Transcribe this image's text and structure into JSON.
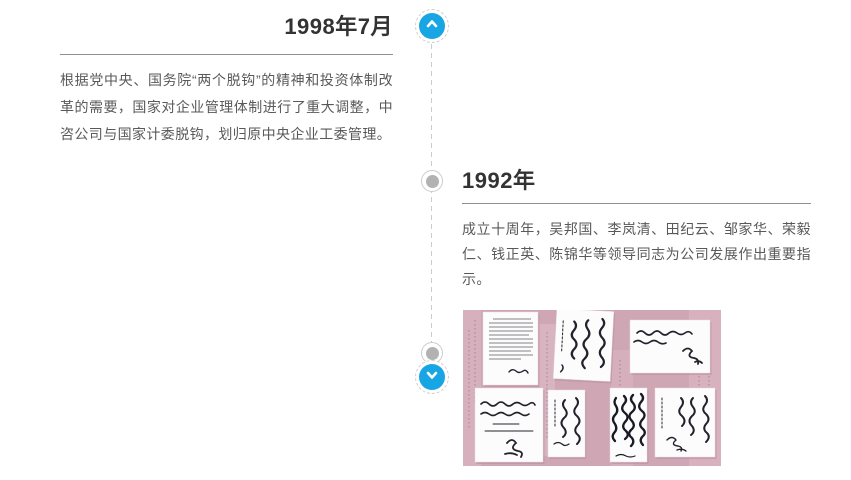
{
  "timeline": {
    "accent_color": "#17a5e3",
    "line_color": "#cccccc",
    "node_color": "#b2b2b2",
    "up_button": {
      "icon": "chevron-up"
    },
    "down_button": {
      "icon": "chevron-down"
    }
  },
  "events": [
    {
      "side": "left",
      "title": "1998年7月",
      "body": "根据党中央、国务院“两个脱钩”的精神和投资体制改革的需要，国家对企业管理体制进行了重大调整，中咨公司与国家计委脱钩，划归原中央企业工委管理。"
    },
    {
      "side": "right",
      "title": "1992年",
      "body": "成立十周年，吴邦国、李岚清、田纪云、邹家华、荣毅仁、钱正英、陈锦华等领导同志为公司发展作出重要指示。",
      "photo": {
        "content": "inscriptions-collage",
        "background_color": "#cfa7b4",
        "paper_color": "#fdfcfc",
        "ink_color": "#22222c"
      }
    }
  ]
}
